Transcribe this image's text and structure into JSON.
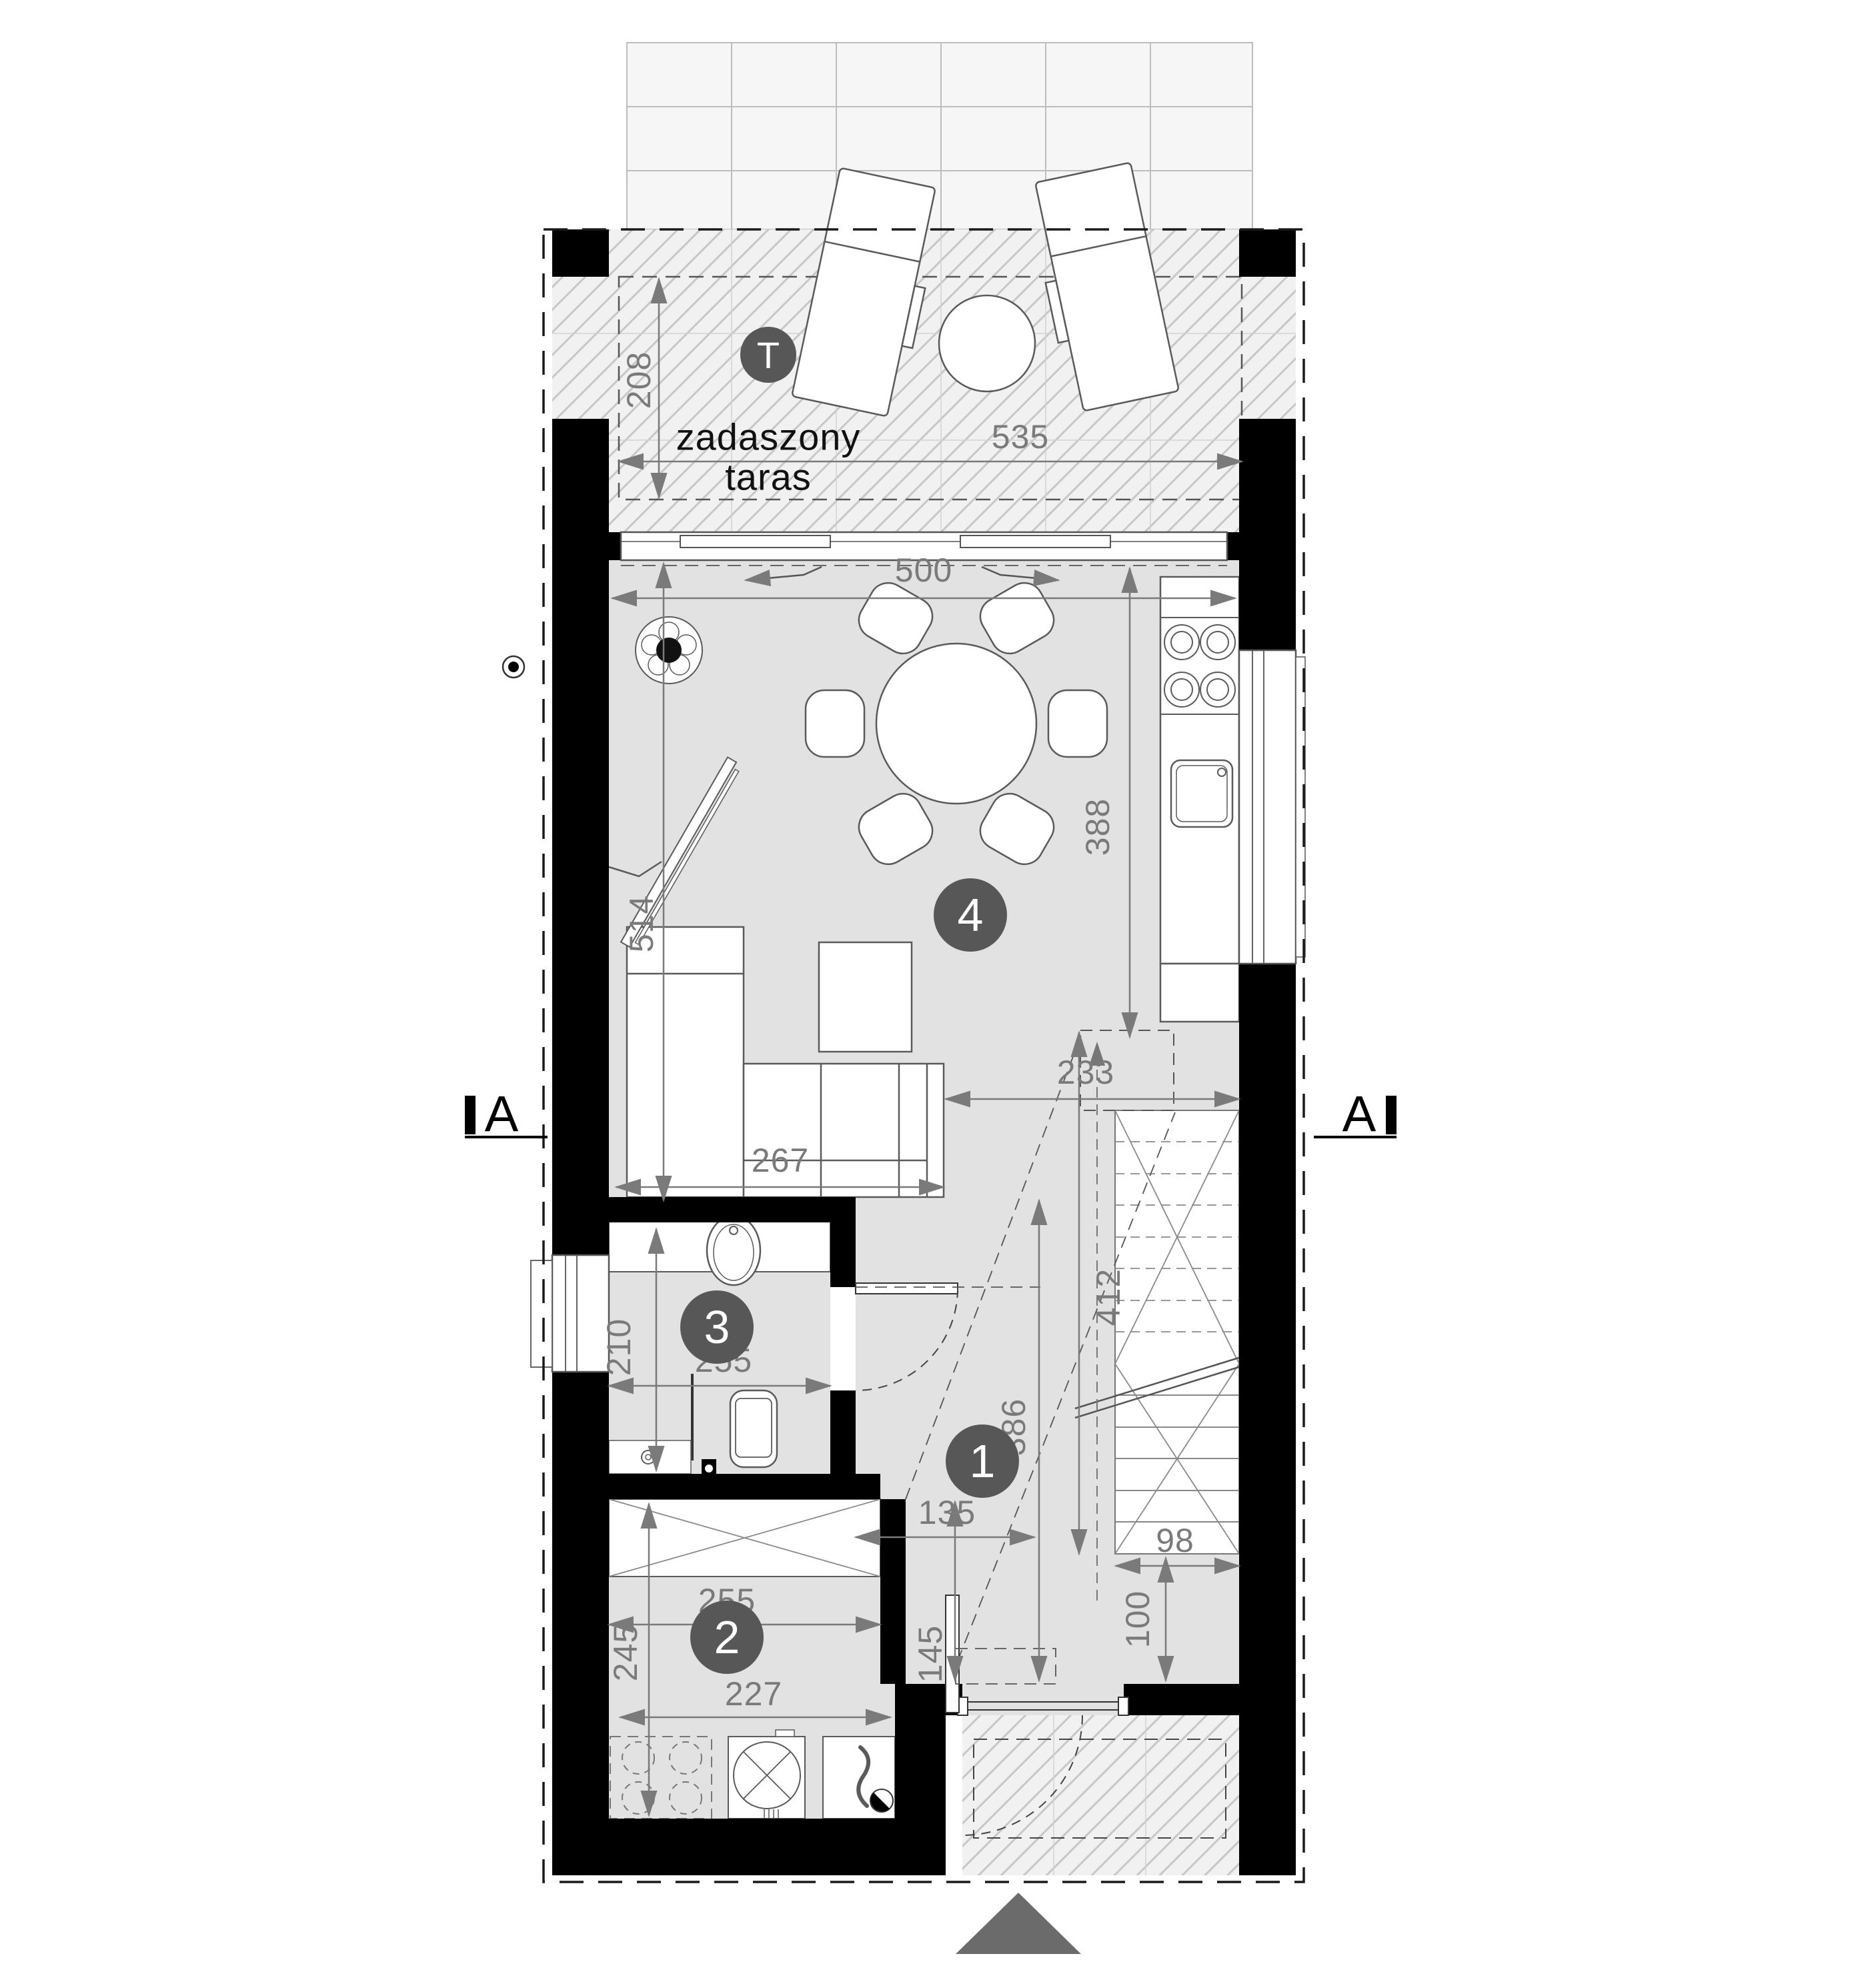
{
  "terrace": {
    "badge": "T",
    "line1": "zadaszony",
    "line2": "taras"
  },
  "rooms": {
    "r1": "1",
    "r2": "2",
    "r3": "3",
    "r4": "4"
  },
  "section": {
    "letter": "A"
  },
  "dims": {
    "terrace_depth": "208",
    "terrace_width": "535",
    "living_width": "500",
    "kitchen_run": "388",
    "living_depth": "514",
    "sofa_run": "267",
    "closet_top": "233",
    "stair_run": "412",
    "bath_depth": "210",
    "bath_width": "255",
    "hall_depth": "386",
    "hall_width": "135",
    "stair_width": "98",
    "wardrobe_width": "255",
    "room2_depth": "245",
    "room2_width": "227",
    "nook_depth": "145",
    "entry_depth": "100"
  },
  "colors": {
    "wall": "#000000",
    "badge": "#575757",
    "dim": "#7a7a7a",
    "floor": "#e2e2e2"
  }
}
